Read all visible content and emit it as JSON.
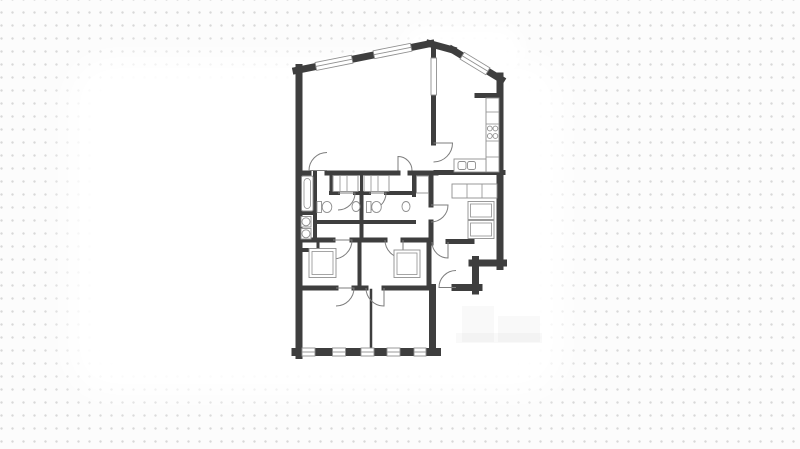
{
  "page": {
    "background_color": "#fcfcfc",
    "dot_color": "#d8d8d8",
    "dot_spacing_x": 11,
    "dot_spacing_y": 13
  },
  "floorplan": {
    "wall_color": "#3E3E3E",
    "line_color": "#8f8f8f",
    "door_color": "#7d7d7d",
    "outline": "M292.5,64 L432.5,39.5 Q447,41.5 456,47 L504.5,76.5 L504.5,266.5 L479.5,266.5 L479.5,291.5 L436.5,291.5 L436.5,356 L292.5,356 Z",
    "walls": [
      {
        "x1": 299,
        "y1": 67.5,
        "x2": 299,
        "y2": 355.5,
        "w": 7,
        "n": "wall-exterior-left"
      },
      {
        "x1": 295.5,
        "y1": 352,
        "x2": 437,
        "y2": 352,
        "w": 8,
        "n": "wall-exterior-bottom"
      },
      {
        "x1": 432.5,
        "y1": 352,
        "x2": 432.5,
        "y2": 287.5,
        "w": 7,
        "n": "wall-exterior-bedroom-right"
      },
      {
        "x1": 455,
        "y1": 287.5,
        "x2": 479,
        "y2": 287.5,
        "w": 7,
        "n": "wall-exterior-step"
      },
      {
        "x1": 475.5,
        "y1": 291,
        "x2": 475.5,
        "y2": 259.5,
        "w": 7,
        "n": "wall-exterior-step"
      },
      {
        "x1": 472,
        "y1": 263,
        "x2": 503.5,
        "y2": 263,
        "w": 7,
        "n": "wall-exterior-step"
      },
      {
        "x1": 500,
        "y1": 266.5,
        "x2": 500,
        "y2": 76,
        "w": 7,
        "n": "wall-exterior-right"
      },
      {
        "x1": 501.5,
        "y1": 79.5,
        "x2": 452,
        "y2": 49.5,
        "w": 7,
        "n": "wall-exterior-diagonal-right"
      },
      {
        "x1": 453,
        "y1": 50,
        "x2": 429.5,
        "y2": 43.5,
        "w": 7,
        "n": "wall-exterior-ridge"
      },
      {
        "x1": 431,
        "y1": 43.5,
        "x2": 296,
        "y2": 70.5,
        "w": 7,
        "n": "wall-exterior-diagonal-left"
      },
      {
        "x1": 302,
        "y1": 173,
        "x2": 309,
        "y2": 173,
        "w": 5,
        "n": "wall-living-south"
      },
      {
        "x1": 327,
        "y1": 173,
        "x2": 398,
        "y2": 173,
        "w": 5,
        "n": "wall-living-south"
      },
      {
        "x1": 410,
        "y1": 173,
        "x2": 436,
        "y2": 173,
        "w": 5,
        "n": "wall-living-south"
      },
      {
        "x1": 433.5,
        "y1": 47,
        "x2": 433.5,
        "y2": 58,
        "w": 5,
        "n": "wall-kitchen-divider"
      },
      {
        "x1": 433.5,
        "y1": 95,
        "x2": 433.5,
        "y2": 143,
        "w": 5,
        "n": "wall-kitchen-divider"
      },
      {
        "x1": 436,
        "y1": 172.5,
        "x2": 503,
        "y2": 172.5,
        "w": 5,
        "n": "wall-kitchen-south"
      },
      {
        "x1": 477,
        "y1": 95.5,
        "x2": 500,
        "y2": 95.5,
        "w": 5,
        "n": "wall-kitchen-stub"
      },
      {
        "x1": 431,
        "y1": 175,
        "x2": 431,
        "y2": 205,
        "w": 5,
        "n": "wall-hall-west"
      },
      {
        "x1": 431,
        "y1": 222,
        "x2": 431,
        "y2": 243,
        "w": 5,
        "n": "wall-hall-west"
      },
      {
        "x1": 331,
        "y1": 193,
        "x2": 338,
        "y2": 193,
        "w": 4,
        "n": "wall-bathroom-north"
      },
      {
        "x1": 355,
        "y1": 193,
        "x2": 369,
        "y2": 193,
        "w": 4,
        "n": "wall-bathroom-north"
      },
      {
        "x1": 386,
        "y1": 193,
        "x2": 412,
        "y2": 193,
        "w": 4,
        "n": "wall-bathroom-north"
      },
      {
        "x1": 331,
        "y1": 173,
        "x2": 331,
        "y2": 193,
        "w": 3,
        "n": "wall-wardrobe-strip"
      },
      {
        "x1": 361.5,
        "y1": 175,
        "x2": 361.5,
        "y2": 193,
        "w": 3,
        "n": "wall-wardrobe-strip"
      },
      {
        "x1": 361.5,
        "y1": 193,
        "x2": 361.5,
        "y2": 240,
        "w": 4,
        "n": "wall-between-bathrooms"
      },
      {
        "x1": 414,
        "y1": 173,
        "x2": 414,
        "y2": 195,
        "w": 4,
        "n": "wall-hall-nook"
      },
      {
        "x1": 315,
        "y1": 222,
        "x2": 414,
        "y2": 222,
        "w": 4,
        "n": "wall-corridor-north"
      },
      {
        "x1": 315,
        "y1": 173,
        "x2": 315,
        "y2": 240,
        "w": 4,
        "n": "wall-bath-strip-east"
      },
      {
        "x1": 302,
        "y1": 213,
        "x2": 315,
        "y2": 213,
        "w": 4,
        "n": "wall-bath-strip"
      },
      {
        "x1": 302,
        "y1": 250,
        "x2": 318,
        "y2": 250,
        "w": 4,
        "n": "wall-laundry-south"
      },
      {
        "x1": 318,
        "y1": 240,
        "x2": 318,
        "y2": 250,
        "w": 3,
        "n": "wall-laundry-east"
      },
      {
        "x1": 302,
        "y1": 240,
        "x2": 333,
        "y2": 240,
        "w": 5,
        "n": "wall-corridor-south"
      },
      {
        "x1": 352,
        "y1": 240,
        "x2": 385,
        "y2": 240,
        "w": 5,
        "n": "wall-corridor-south"
      },
      {
        "x1": 403,
        "y1": 240,
        "x2": 431,
        "y2": 240,
        "w": 5,
        "n": "wall-corridor-south"
      },
      {
        "x1": 448,
        "y1": 241.5,
        "x2": 472,
        "y2": 241.5,
        "w": 5,
        "n": "wall-vestibule-north"
      },
      {
        "x1": 359.5,
        "y1": 240,
        "x2": 359.5,
        "y2": 288,
        "w": 4,
        "n": "wall-between-closets"
      },
      {
        "x1": 429,
        "y1": 240,
        "x2": 429,
        "y2": 288,
        "w": 5,
        "n": "wall-closet-east"
      },
      {
        "x1": 302,
        "y1": 288,
        "x2": 336,
        "y2": 288,
        "w": 5,
        "n": "wall-bedroom-north"
      },
      {
        "x1": 354,
        "y1": 288,
        "x2": 366,
        "y2": 288,
        "w": 5,
        "n": "wall-bedroom-north"
      },
      {
        "x1": 384,
        "y1": 288,
        "x2": 429,
        "y2": 288,
        "w": 5,
        "n": "wall-bedroom-north"
      },
      {
        "x1": 371,
        "y1": 290,
        "x2": 371,
        "y2": 352,
        "w": 2.5,
        "n": "wall-between-bedrooms"
      }
    ],
    "windows": [
      {
        "cx": 308.5,
        "cy": 352,
        "len": 13,
        "ang": 0
      },
      {
        "cx": 339,
        "cy": 352,
        "len": 13,
        "ang": 0
      },
      {
        "cx": 367.5,
        "cy": 352,
        "len": 13,
        "ang": 0
      },
      {
        "cx": 393.5,
        "cy": 352,
        "len": 13,
        "ang": 0
      },
      {
        "cx": 420,
        "cy": 352,
        "len": 12,
        "ang": 0
      },
      {
        "cx": 334,
        "cy": 62.8,
        "len": 37,
        "ang": -11.3
      },
      {
        "cx": 392.5,
        "cy": 51,
        "len": 38,
        "ang": -11.3
      },
      {
        "cx": 475,
        "cy": 63.5,
        "len": 30,
        "ang": 31.2
      }
    ],
    "doors": [
      {
        "hx": 327,
        "hy": 170.5,
        "r": 18,
        "a1": 180,
        "a2": 270
      },
      {
        "hx": 398,
        "hy": 170.5,
        "r": 14,
        "a1": 270,
        "a2": 360
      },
      {
        "hx": 433.5,
        "hy": 143,
        "r": 19,
        "a1": 0,
        "a2": 90
      },
      {
        "hx": 431,
        "hy": 205,
        "r": 17,
        "a1": 0,
        "a2": 90
      },
      {
        "hx": 333,
        "hy": 240,
        "r": 19,
        "a1": 0,
        "a2": 90
      },
      {
        "hx": 403,
        "hy": 240,
        "r": 18,
        "a1": 90,
        "a2": 180
      },
      {
        "hx": 336,
        "hy": 288,
        "r": 18,
        "a1": 0,
        "a2": 90
      },
      {
        "hx": 384,
        "hy": 288,
        "r": 18,
        "a1": 90,
        "a2": 180
      },
      {
        "hx": 338,
        "hy": 193,
        "r": 17,
        "a1": 0,
        "a2": 90
      },
      {
        "hx": 369,
        "hy": 193,
        "r": 17,
        "a1": 0,
        "a2": 90
      },
      {
        "hx": 448,
        "hy": 242,
        "r": 16,
        "a1": 90,
        "a2": 180
      },
      {
        "hx": 456,
        "hy": 287.5,
        "r": 17,
        "a1": 180,
        "a2": 270
      }
    ],
    "fixtures": [
      {
        "t": "irect",
        "n": "bathtub",
        "x": 301.5,
        "y": 176,
        "w": 11.5,
        "h": 35,
        "rx": 1.5,
        "ins": 2.5,
        "irx": 3.5
      },
      {
        "t": "rect",
        "n": "washing-machine",
        "x": 301,
        "y": 216.5,
        "w": 10,
        "h": 10.5
      },
      {
        "t": "circle",
        "n": "washing-machine-drum",
        "cx": 306,
        "cy": 221.8,
        "r": 4
      },
      {
        "t": "rect",
        "n": "dryer",
        "x": 301,
        "y": 228.5,
        "w": 10,
        "h": 10.5
      },
      {
        "t": "circle",
        "n": "dryer-drum",
        "cx": 306,
        "cy": 233.8,
        "r": 4
      },
      {
        "t": "rect",
        "n": "glass-pocket-door",
        "x": 431,
        "y": 58,
        "w": 5.5,
        "h": 37
      },
      {
        "t": "rect",
        "n": "kitchen-counter",
        "x": 486,
        "y": 98,
        "w": 13,
        "h": 74
      },
      {
        "t": "line",
        "n": "counter-divider",
        "x1": 486,
        "y1": 112,
        "x2": 499,
        "y2": 112
      },
      {
        "t": "line",
        "n": "counter-divider",
        "x1": 486,
        "y1": 124,
        "x2": 499,
        "y2": 124
      },
      {
        "t": "line",
        "n": "counter-divider",
        "x1": 486,
        "y1": 141,
        "x2": 499,
        "y2": 141
      },
      {
        "t": "line",
        "n": "counter-divider",
        "x1": 486,
        "y1": 157,
        "x2": 499,
        "y2": 157
      },
      {
        "t": "circle",
        "n": "stove-burner",
        "cx": 489.8,
        "cy": 128.5,
        "r": 2.4
      },
      {
        "t": "circle",
        "n": "stove-burner",
        "cx": 495.4,
        "cy": 128.5,
        "r": 2.4
      },
      {
        "t": "circle",
        "n": "stove-burner",
        "cx": 489.8,
        "cy": 136,
        "r": 2.4
      },
      {
        "t": "circle",
        "n": "stove-burner",
        "cx": 495.4,
        "cy": 136,
        "r": 2.4
      },
      {
        "t": "rect",
        "n": "kitchen-sink-counter",
        "x": 454,
        "y": 159,
        "w": 32,
        "h": 13
      },
      {
        "t": "rect",
        "n": "kitchen-sink-bowl",
        "x": 458,
        "y": 161.5,
        "w": 8,
        "h": 8,
        "rx": 2
      },
      {
        "t": "rect",
        "n": "kitchen-sink-bowl",
        "x": 467.5,
        "y": 161.5,
        "w": 8,
        "h": 8,
        "rx": 2
      },
      {
        "t": "rect",
        "n": "wardrobe-shelf",
        "x": 333,
        "y": 175.5,
        "w": 25,
        "h": 16
      },
      {
        "t": "line",
        "n": "wardrobe-rod",
        "x1": 340,
        "y1": 176,
        "x2": 340,
        "y2": 191
      },
      {
        "t": "line",
        "n": "wardrobe-rod",
        "x1": 347,
        "y1": 176,
        "x2": 347,
        "y2": 191
      },
      {
        "t": "rect",
        "n": "wardrobe-shelf",
        "x": 364,
        "y": 175.5,
        "w": 25,
        "h": 16
      },
      {
        "t": "line",
        "n": "wardrobe-rod",
        "x1": 371,
        "y1": 176,
        "x2": 371,
        "y2": 191
      },
      {
        "t": "line",
        "n": "wardrobe-rod",
        "x1": 378,
        "y1": 176,
        "x2": 378,
        "y2": 191
      },
      {
        "t": "rect",
        "n": "toilet-tank",
        "x": 317,
        "y": 201.5,
        "w": 4.5,
        "h": 11
      },
      {
        "t": "ellipse",
        "n": "toilet-bowl",
        "cx": 327,
        "cy": 207,
        "rx": 4.8,
        "ry": 5.6
      },
      {
        "t": "ellipse",
        "n": "basin",
        "cx": 356,
        "cy": 206.5,
        "rx": 4,
        "ry": 5
      },
      {
        "t": "rect",
        "n": "toilet-tank",
        "x": 366.5,
        "y": 201.5,
        "w": 4.5,
        "h": 11
      },
      {
        "t": "ellipse",
        "n": "toilet-bowl",
        "cx": 376.5,
        "cy": 207,
        "rx": 4.8,
        "ry": 5.6
      },
      {
        "t": "ellipse",
        "n": "basin",
        "cx": 406,
        "cy": 206.5,
        "rx": 4,
        "ry": 5
      },
      {
        "t": "rect",
        "n": "hall-cabinet",
        "x": 416.5,
        "y": 176,
        "w": 12,
        "h": 17
      },
      {
        "t": "rect",
        "n": "storage-unit",
        "x": 452,
        "y": 184,
        "w": 45,
        "h": 14
      },
      {
        "t": "line",
        "n": "storage-divider",
        "x1": 467,
        "y1": 184,
        "x2": 467,
        "y2": 198
      },
      {
        "t": "line",
        "n": "storage-divider",
        "x1": 482,
        "y1": 184,
        "x2": 482,
        "y2": 198
      },
      {
        "t": "irect",
        "n": "hall-closet",
        "x": 468,
        "y": 201.5,
        "w": 26,
        "h": 18,
        "ins": 2.5
      },
      {
        "t": "irect",
        "n": "hall-closet",
        "x": 468,
        "y": 220.5,
        "w": 26,
        "h": 18,
        "ins": 2.5
      },
      {
        "t": "irect",
        "n": "walkin-wardrobe",
        "x": 309,
        "y": 248.5,
        "w": 27,
        "h": 29,
        "ins": 3
      },
      {
        "t": "irect",
        "n": "walkin-wardrobe",
        "x": 394,
        "y": 250,
        "w": 26,
        "h": 27.5,
        "ins": 3
      }
    ]
  },
  "watermark": {
    "color": "rgba(0,0,0,0.022)",
    "blocks": [
      {
        "x": 462,
        "y": 306,
        "w": 32,
        "h": 36
      },
      {
        "x": 498,
        "y": 316,
        "w": 42,
        "h": 26
      },
      {
        "x": 456,
        "y": 333,
        "w": 86,
        "h": 10
      }
    ]
  }
}
